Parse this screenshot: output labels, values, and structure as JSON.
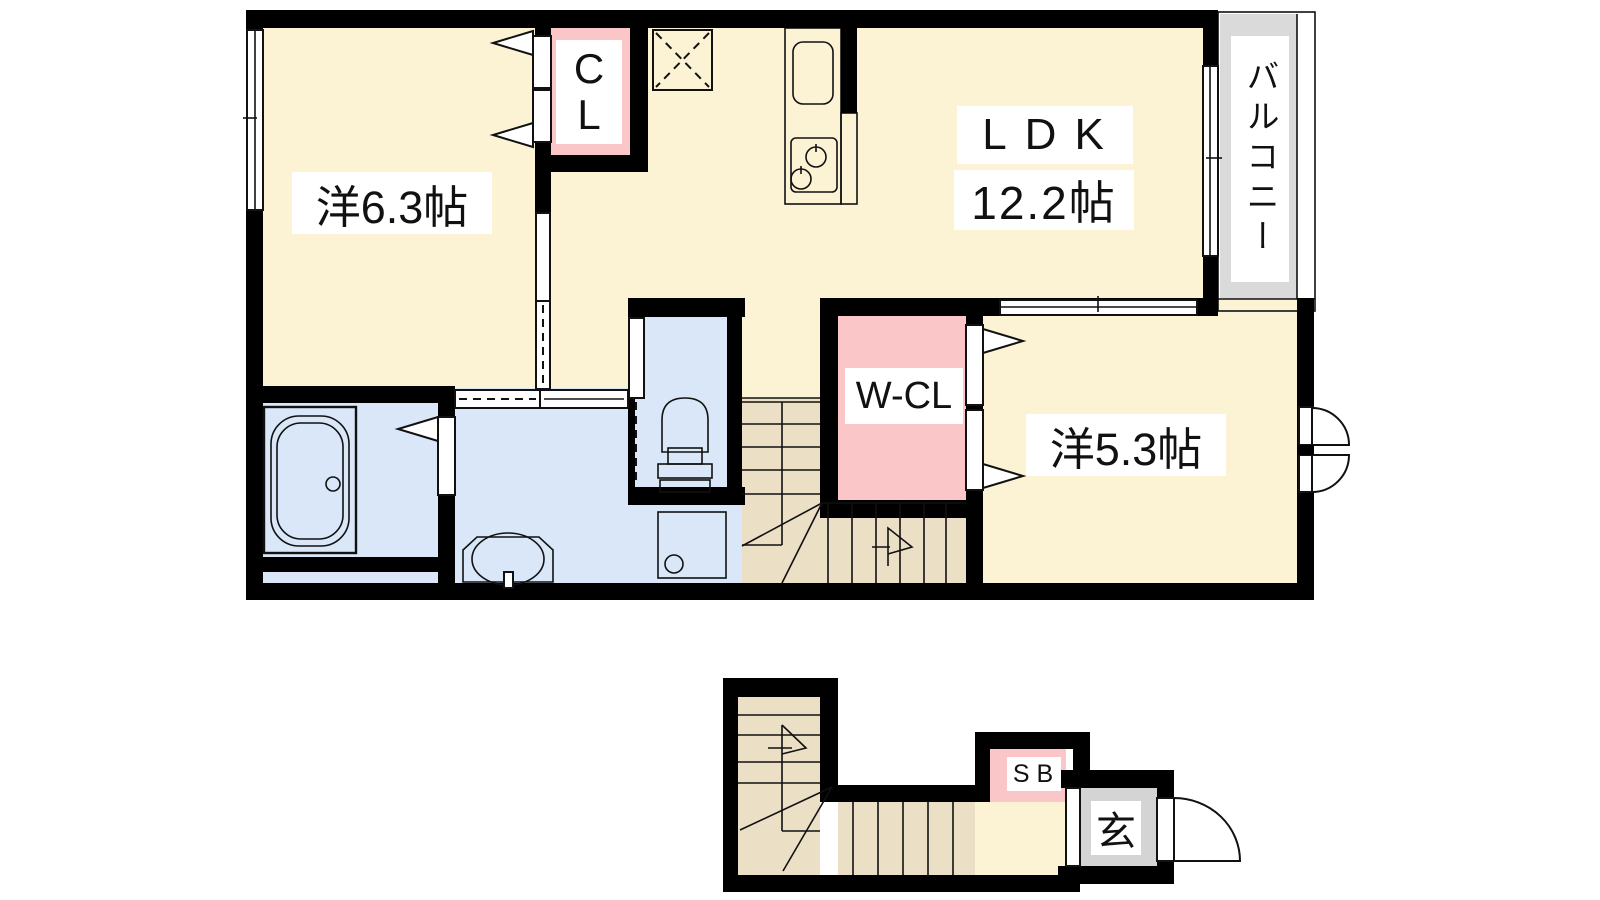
{
  "plan": {
    "second_floor": {
      "western_room_large": "洋6.3帖",
      "closet_line1": "C",
      "closet_line2": "L",
      "ldk_name": "LDK",
      "ldk_size": "12.2帖",
      "walk_in_closet": "W-CL",
      "western_room_small": "洋5.3帖",
      "balcony": "バルコニー"
    },
    "first_floor": {
      "shoe_box": "SB",
      "entrance": "玄"
    }
  },
  "colors": {
    "wall": "#000000",
    "room_floor": "#FCF2D4",
    "stair_floor": "#EBDFC5",
    "closet_pink": "#FBC6C8",
    "wet_area_blue": "#D9E7F8",
    "kitchen_lavender": "#E5DBF2",
    "counter_tan": "#EFE3C4",
    "balcony_gray": "#DADADA",
    "entrance_gray": "#D4D4D4",
    "label_background": "#FFFFFF"
  }
}
